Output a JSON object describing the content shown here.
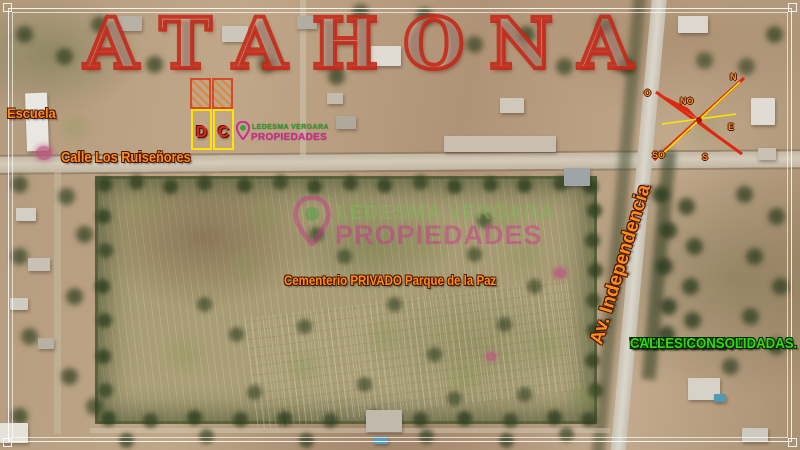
{
  "header": {
    "title": "ATAHONA"
  },
  "map_labels": {
    "school": "Escuela",
    "street": "Calle Los Ruiseñores",
    "cemetery": "Cementerio PRIVADO Parque de la Paz",
    "avenue": "Av. Independencia"
  },
  "lots": {
    "lot_d": "D",
    "lot_c": "C"
  },
  "brand": {
    "name": "LEDESMA VERGARA",
    "type": "PROPIEDADES"
  },
  "features": {
    "bullet": "*",
    "items": [
      "TITULO PERFECTO.",
      "AGUA DE RED.",
      "ELECTRICIDAD.",
      "CALLES CONSOLIDADAS."
    ]
  },
  "compass": {
    "n": "N",
    "no": "NO",
    "o": "O",
    "e": "E",
    "s": "S",
    "so": "SO"
  },
  "colors": {
    "accent_orange": "#ff8c1c",
    "accent_green": "#33d813",
    "accent_yellow": "#ffe400",
    "title_red": "#c62717",
    "brand_green": "#2f9e2f",
    "brand_magenta": "#d02a90"
  }
}
